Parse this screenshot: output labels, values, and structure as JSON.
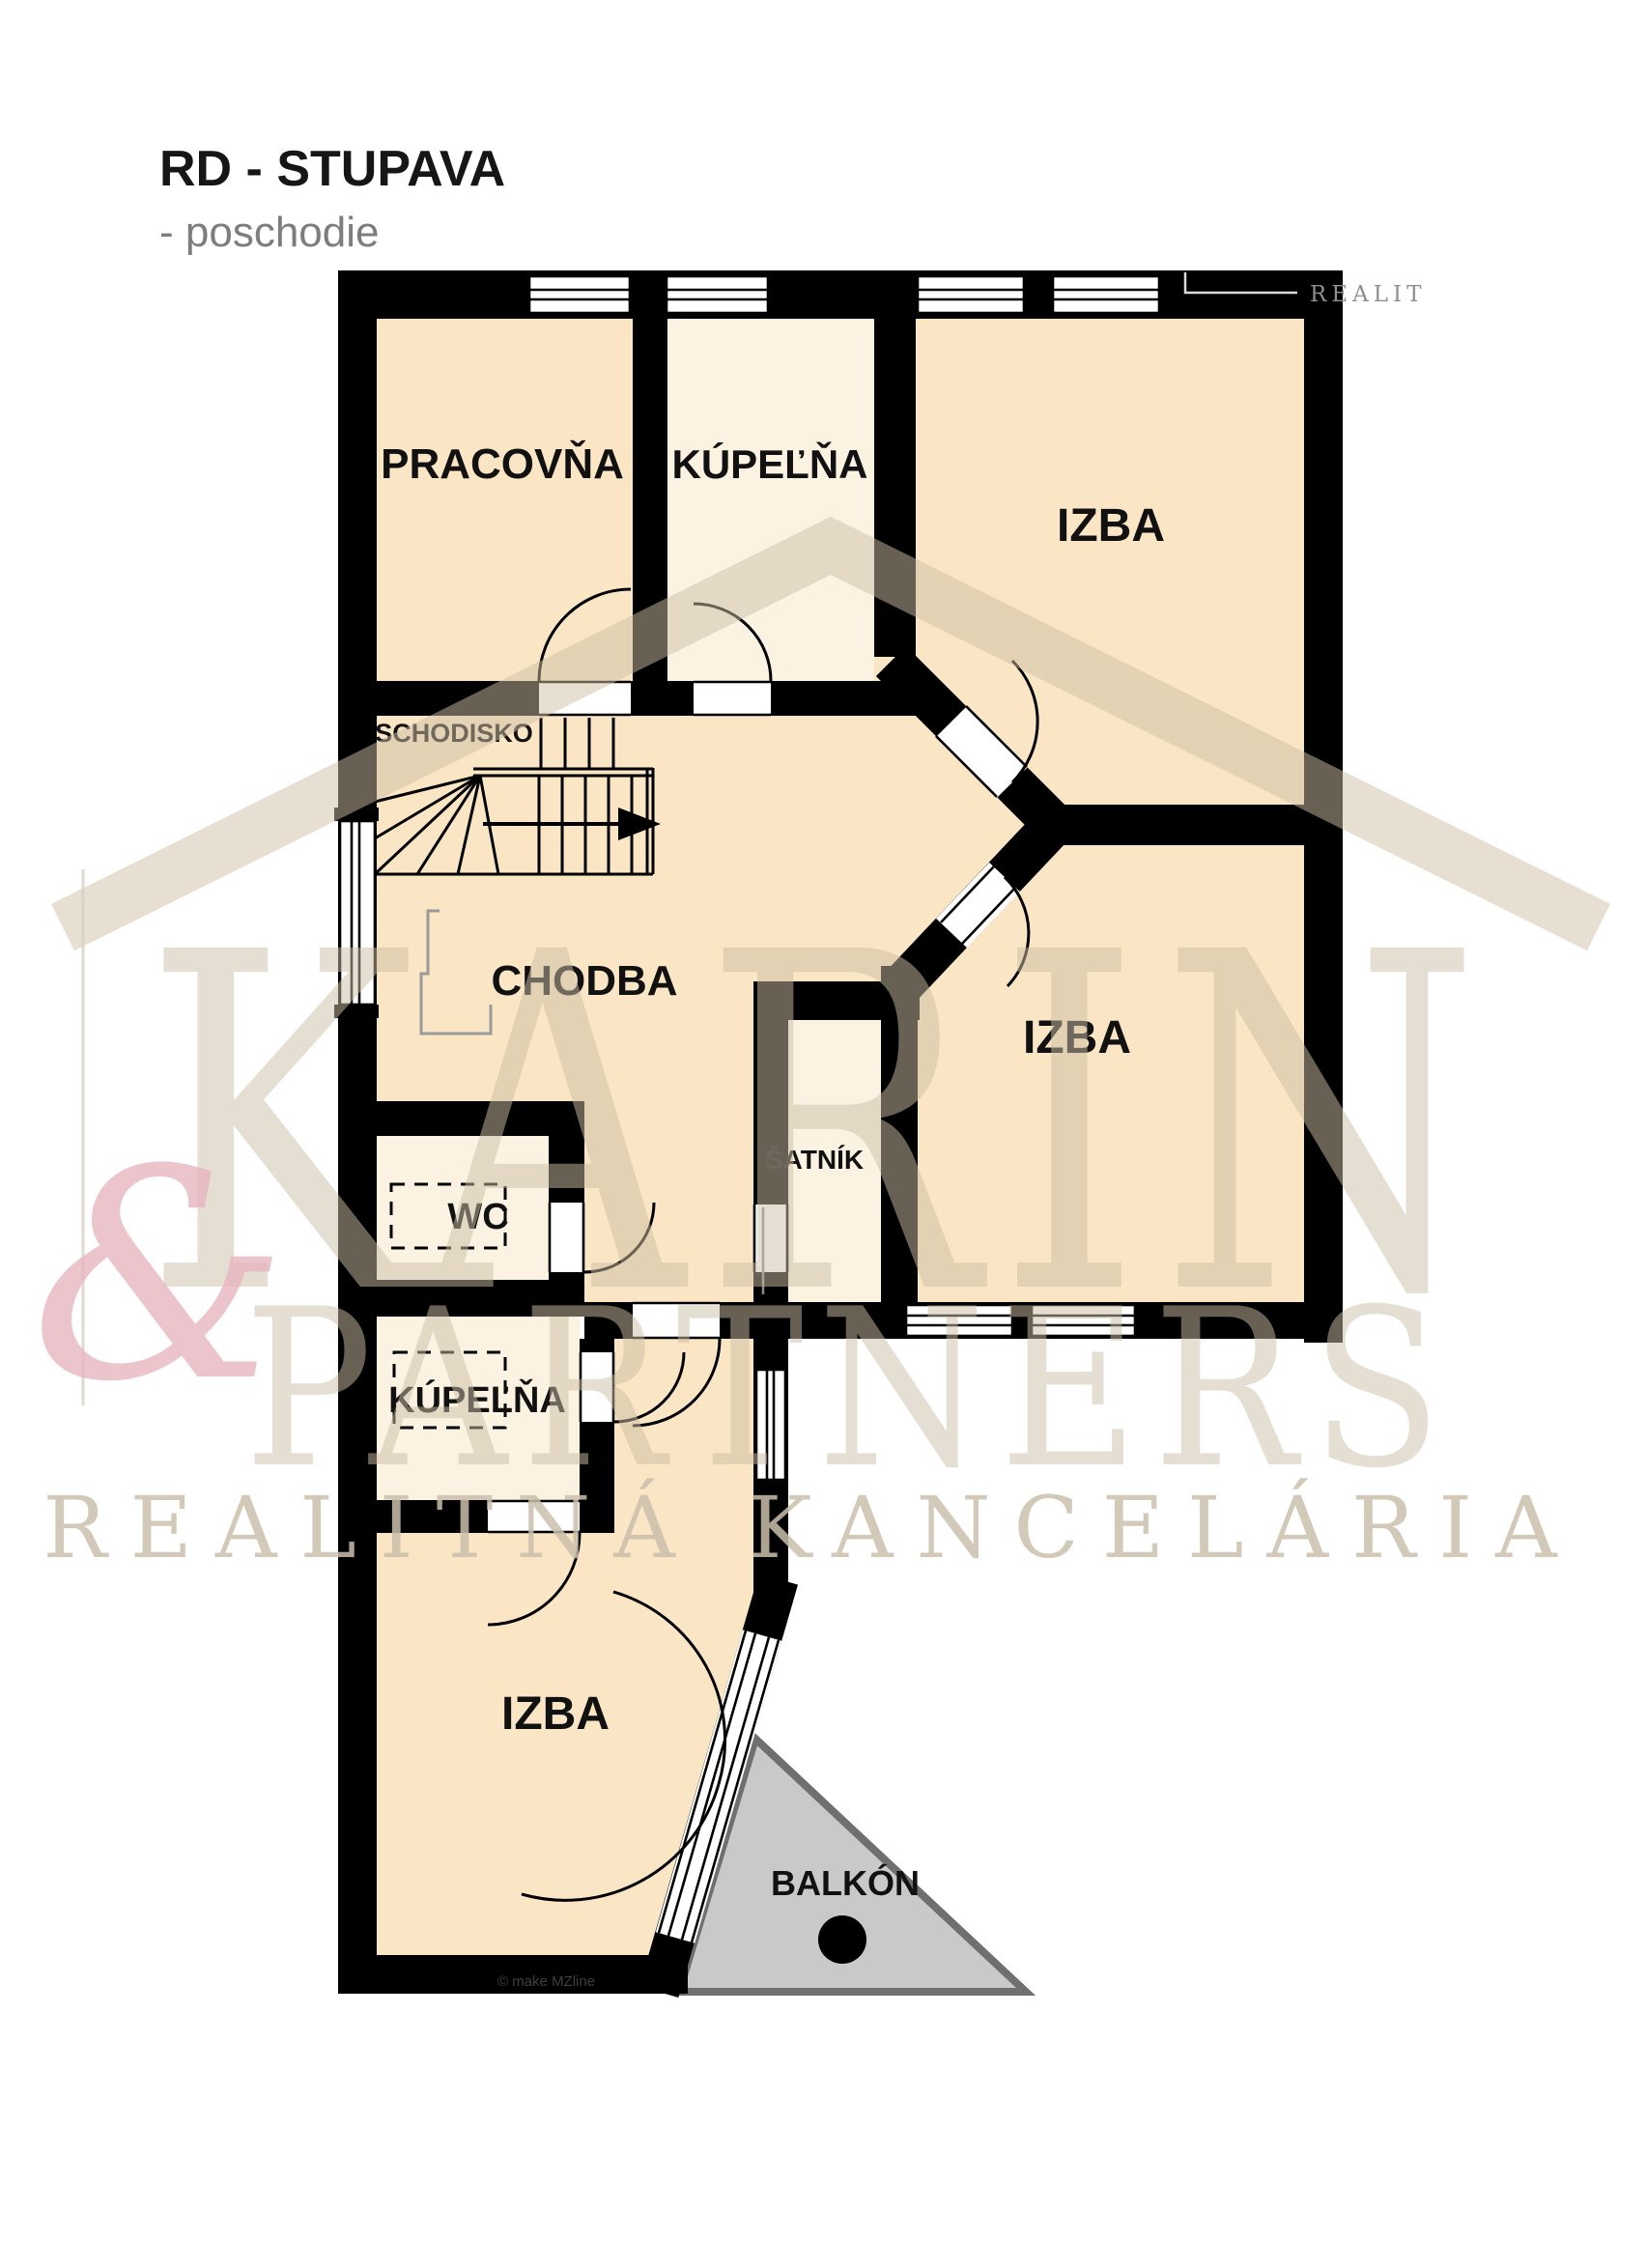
{
  "title": {
    "main": "RD - STUPAVA",
    "subtitle": "- poschodie"
  },
  "rooms": {
    "pracovna": "PRACOVŇA",
    "kupelna_top": "KÚPEĽŇA",
    "izba_top": "IZBA",
    "schodisko": "SCHODISKO",
    "chodba": "CHODBA",
    "izba_right": "IZBA",
    "satnik": "ŠATNÍK",
    "wc": "WC",
    "kupelna_bottom": "KÚPEĽŇA",
    "izba_bottom": "IZBA",
    "balkon": "BALKÓN"
  },
  "watermark": {
    "brand": "KARIN",
    "ampersand": "&",
    "brand2": "PARTNERS",
    "tagline": "REALITNÁ KANCELÁRIA",
    "corner_text": "REALIT"
  },
  "copyright": "© make MZline",
  "colors": {
    "room_peach": "#FAE5C4",
    "room_cream": "#FBF2E2",
    "wall": "#000000",
    "balcony_fill": "#C9C9C9",
    "balcony_border": "#6F6F6F",
    "watermark_tan": "#CDBFA6",
    "watermark_pink": "#E8B6C0",
    "subtitle_gray": "#7D7D7D"
  }
}
